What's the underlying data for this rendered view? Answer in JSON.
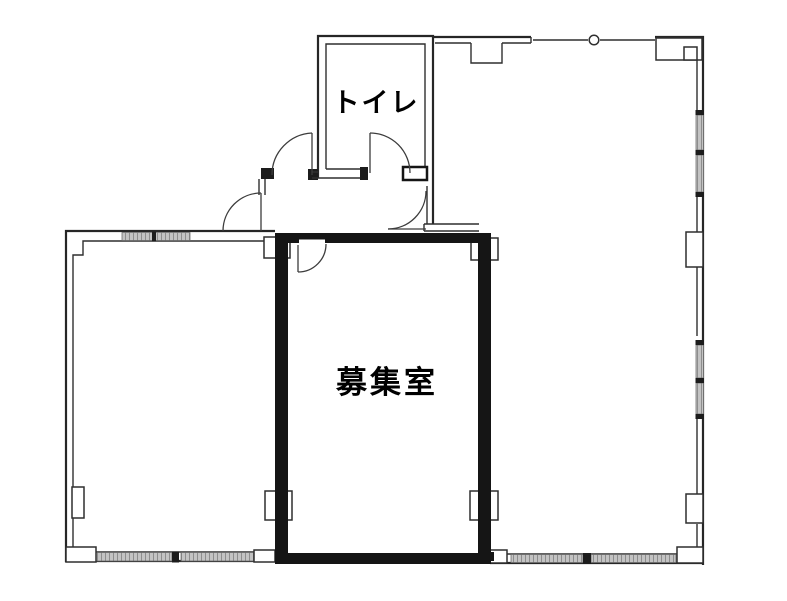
{
  "floorplan": {
    "labels": {
      "toilet": "トイレ",
      "vacant_room": "募集室"
    },
    "colors": {
      "wall_line": "#2f2f2f",
      "emphasis_wall": "#151515",
      "window_fill": "#c3c3c3",
      "window_hatch": "#8d8d8d",
      "background": "#ffffff",
      "label_text": "#000000"
    },
    "symbols": {
      "door_swing": "quarter-circle-arc",
      "window": "hatched-band",
      "column": "white-block-on-wall",
      "vent": "circle-on-wall"
    }
  }
}
